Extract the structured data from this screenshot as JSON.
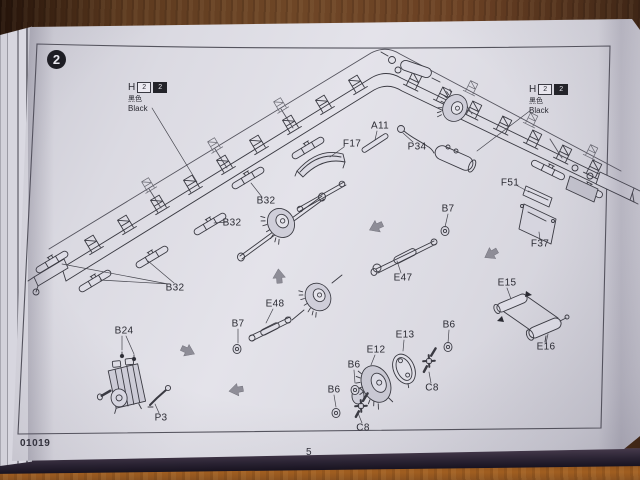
{
  "photo": {
    "subject": "model kit instruction booklet page on wooden table",
    "colors": {
      "wood": "#6e4626",
      "paper": "#dedde5",
      "ink": "#35353d",
      "assembly_arrow": "#8e8d97"
    }
  },
  "page": {
    "step_number": "2",
    "kit_number": "01019",
    "page_number": "5"
  },
  "paint_callouts": [
    {
      "position": "upper-left",
      "code_letter": "H",
      "box1_value": "2",
      "box2_value": "2",
      "color_name_cn": "黑色",
      "color_name_en": "Black"
    },
    {
      "position": "upper-right",
      "code_letter": "H",
      "box1_value": "2",
      "box2_value": "2",
      "color_name_cn": "黑色",
      "color_name_en": "Black"
    }
  ],
  "diagram": {
    "description": "Exploded isometric assembly drawing of a long ladder chassis frame with leaf springs, transfer cases, drive shafts, winch drum and brackets",
    "part_labels": [
      {
        "text": "A11",
        "x": 380,
        "y": 126
      },
      {
        "text": "F17",
        "x": 352,
        "y": 144
      },
      {
        "text": "P34",
        "x": 417,
        "y": 147
      },
      {
        "text": "F51",
        "x": 510,
        "y": 183
      },
      {
        "text": "F37",
        "x": 540,
        "y": 244
      },
      {
        "text": "B7",
        "x": 448,
        "y": 209
      },
      {
        "text": "E47",
        "x": 403,
        "y": 278
      },
      {
        "text": "B32",
        "x": 266,
        "y": 201
      },
      {
        "text": "B32",
        "x": 232,
        "y": 223
      },
      {
        "text": "B32",
        "x": 175,
        "y": 288
      },
      {
        "text": "E48",
        "x": 275,
        "y": 304
      },
      {
        "text": "B7",
        "x": 238,
        "y": 324
      },
      {
        "text": "B24",
        "x": 124,
        "y": 331
      },
      {
        "text": "P3",
        "x": 161,
        "y": 418
      },
      {
        "text": "E15",
        "x": 507,
        "y": 283
      },
      {
        "text": "E16",
        "x": 546,
        "y": 347
      },
      {
        "text": "E13",
        "x": 405,
        "y": 335
      },
      {
        "text": "E12",
        "x": 376,
        "y": 350
      },
      {
        "text": "B6",
        "x": 449,
        "y": 325
      },
      {
        "text": "B6",
        "x": 354,
        "y": 365
      },
      {
        "text": "B6",
        "x": 334,
        "y": 390
      },
      {
        "text": "C8",
        "x": 432,
        "y": 388
      },
      {
        "text": "C8",
        "x": 363,
        "y": 428
      }
    ],
    "assembly_arrows": [
      {
        "x": 376,
        "y": 227,
        "deg": -115
      },
      {
        "x": 491,
        "y": 254,
        "deg": -120
      },
      {
        "x": 279,
        "y": 276,
        "deg": -5
      },
      {
        "x": 188,
        "y": 351,
        "deg": 115
      },
      {
        "x": 236,
        "y": 390,
        "deg": -100
      }
    ]
  }
}
